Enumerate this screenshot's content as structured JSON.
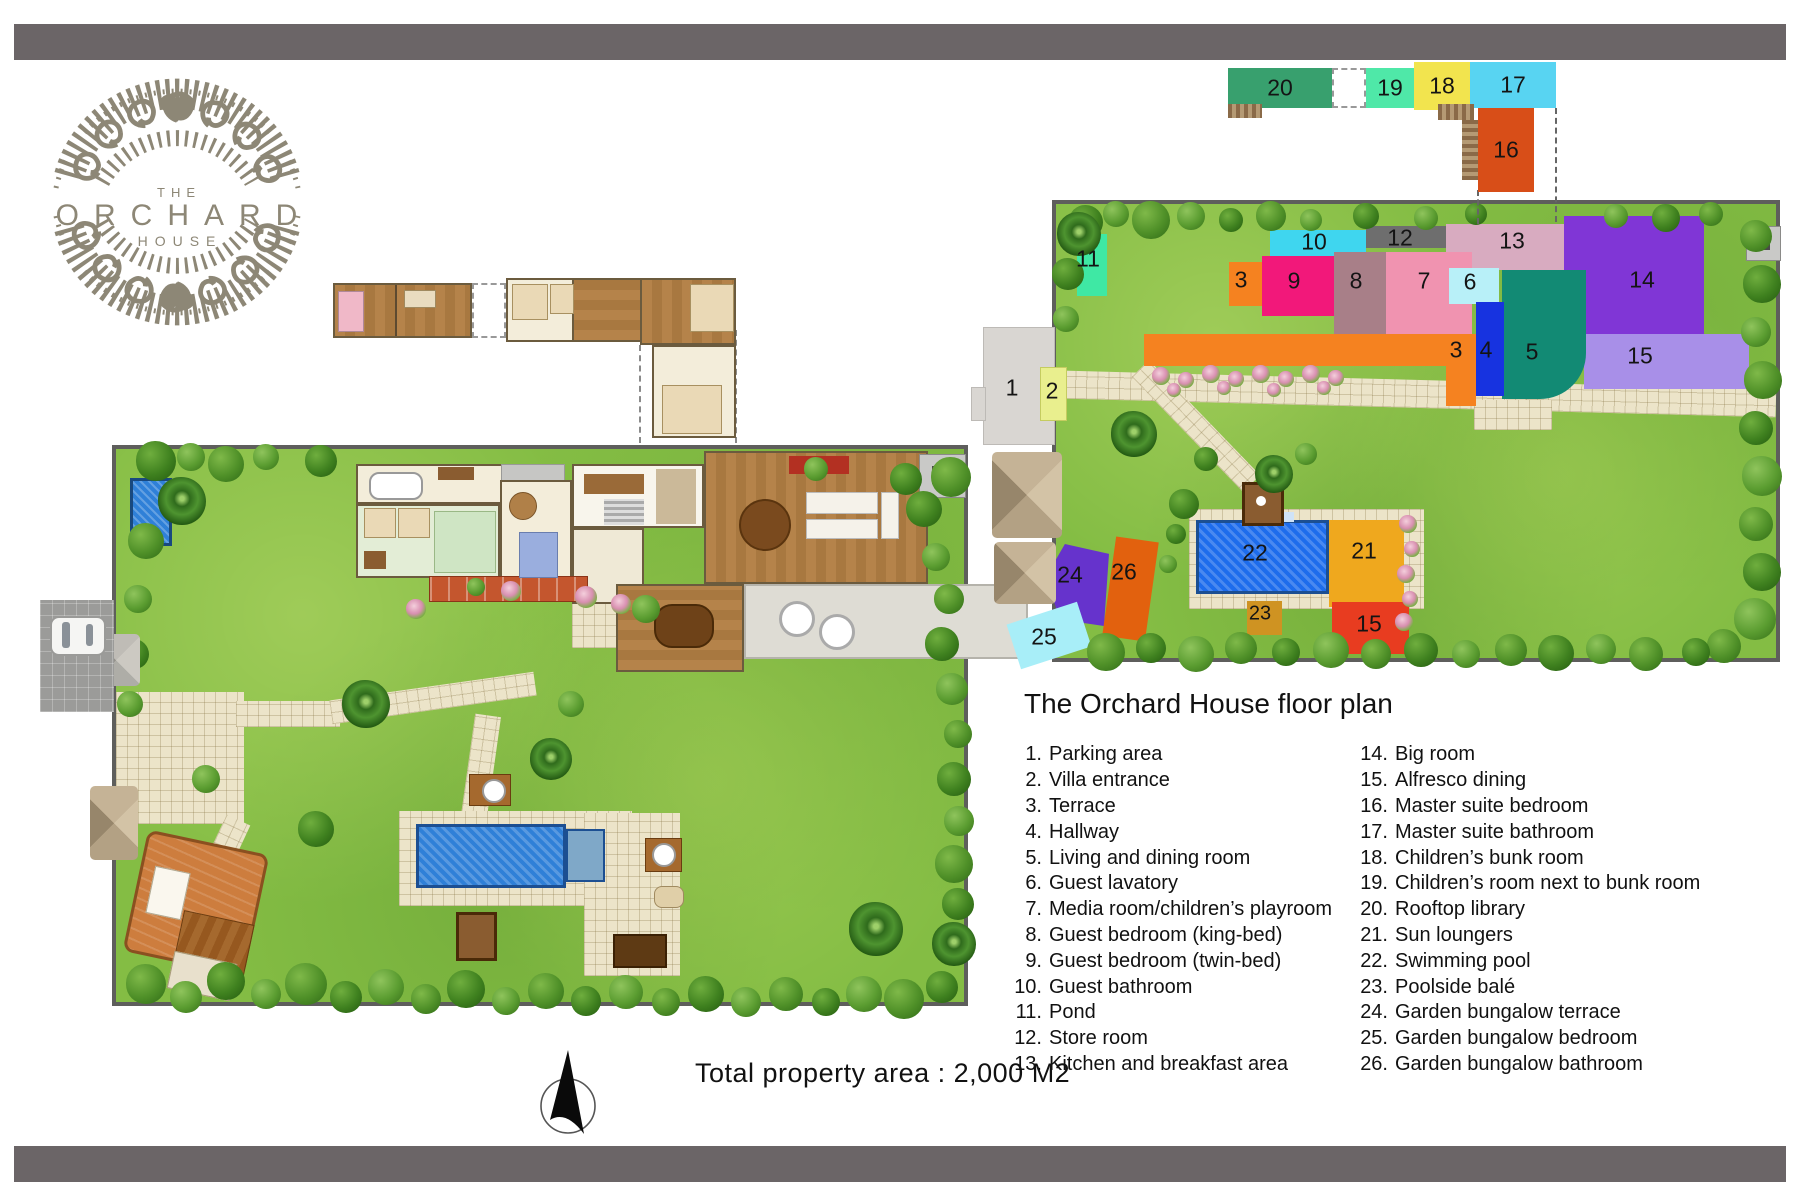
{
  "logo": {
    "top_word": "THE",
    "main_word": "ORCHARD",
    "bottom_word": "HOUSE"
  },
  "floor_plan": {
    "title": "The Orchard House floor plan",
    "total_area": "Total property area : 2,000 M2",
    "legend_col1": [
      {
        "num": "1.",
        "label": "Parking area"
      },
      {
        "num": "2.",
        "label": "Villa entrance"
      },
      {
        "num": "3.",
        "label": "Terrace"
      },
      {
        "num": "4.",
        "label": "Hallway"
      },
      {
        "num": "5.",
        "label": "Living and dining room"
      },
      {
        "num": "6.",
        "label": "Guest lavatory"
      },
      {
        "num": "7.",
        "label": "Media room/children’s playroom"
      },
      {
        "num": "8.",
        "label": "Guest bedroom (king-bed)"
      },
      {
        "num": "9.",
        "label": "Guest bedroom (twin-bed)"
      },
      {
        "num": "10.",
        "label": "Guest bathroom"
      },
      {
        "num": "11.",
        "label": "Pond"
      },
      {
        "num": "12.",
        "label": "Store room"
      },
      {
        "num": "13.",
        "label": "Kitchen and breakfast area"
      }
    ],
    "legend_col2": [
      {
        "num": "14.",
        "label": "Big room"
      },
      {
        "num": "15.",
        "label": "Alfresco dining"
      },
      {
        "num": "16.",
        "label": "Master suite bedroom"
      },
      {
        "num": "17.",
        "label": "Master suite bathroom"
      },
      {
        "num": "18.",
        "label": "Children’s bunk room"
      },
      {
        "num": "19.",
        "label": "Children’s room next to bunk room"
      },
      {
        "num": "20.",
        "label": "Rooftop library"
      },
      {
        "num": "21.",
        "label": "Sun loungers"
      },
      {
        "num": "22.",
        "label": "Swimming pool"
      },
      {
        "num": "23.",
        "label": "Poolside balé"
      },
      {
        "num": "24.",
        "label": "Garden bungalow terrace"
      },
      {
        "num": "25.",
        "label": "Garden bungalow bedroom"
      },
      {
        "num": "26.",
        "label": "Garden bungalow bathroom"
      }
    ]
  },
  "markers": {
    "m1": "1",
    "m2": "2",
    "m3a": "3",
    "m3b": "3",
    "m4": "4",
    "m5": "5",
    "m6": "6",
    "m7": "7",
    "m8": "8",
    "m9": "9",
    "m10": "10",
    "m11": "11",
    "m12": "12",
    "m13": "13",
    "m14": "14",
    "m15a": "15",
    "m15b": "15",
    "m16": "16",
    "m17": "17",
    "m18": "18",
    "m19": "19",
    "m20": "20",
    "m21": "21",
    "m22": "22",
    "m23": "23",
    "m24": "24",
    "m25": "25",
    "m26": "26"
  },
  "colors": {
    "block_1": "#d9d6d2",
    "block_2": "#e9ef8e",
    "block_3": "#f58220",
    "block_4": "#1733e0",
    "block_5": "#128a74",
    "block_6": "#b8f0f8",
    "block_7": "#f093b0",
    "block_8": "#a87f88",
    "block_9": "#f2187a",
    "block_10": "#3fd6ef",
    "block_11": "#3fe8a4",
    "block_12": "#6e6e6e",
    "block_13": "#d8abc0",
    "block_14": "#8036d6",
    "block_15_upper": "#a88fe8",
    "block_15_lower": "#e83c20",
    "block_16": "#d84e18",
    "block_17": "#58d4f2",
    "block_18": "#f2e44e",
    "block_19": "#4fe8a8",
    "block_20": "#38a06e",
    "block_21": "#efa81e",
    "block_22": "#1d6cec",
    "block_23": "#cf9322",
    "block_24": "#6633cc",
    "block_25": "#a8eef8",
    "block_26": "#e2610e",
    "lawn": "#84bd44",
    "pool_water": "#2f80d8",
    "frame_bar": "#6b6567",
    "logo_gray": "#8d8776"
  }
}
